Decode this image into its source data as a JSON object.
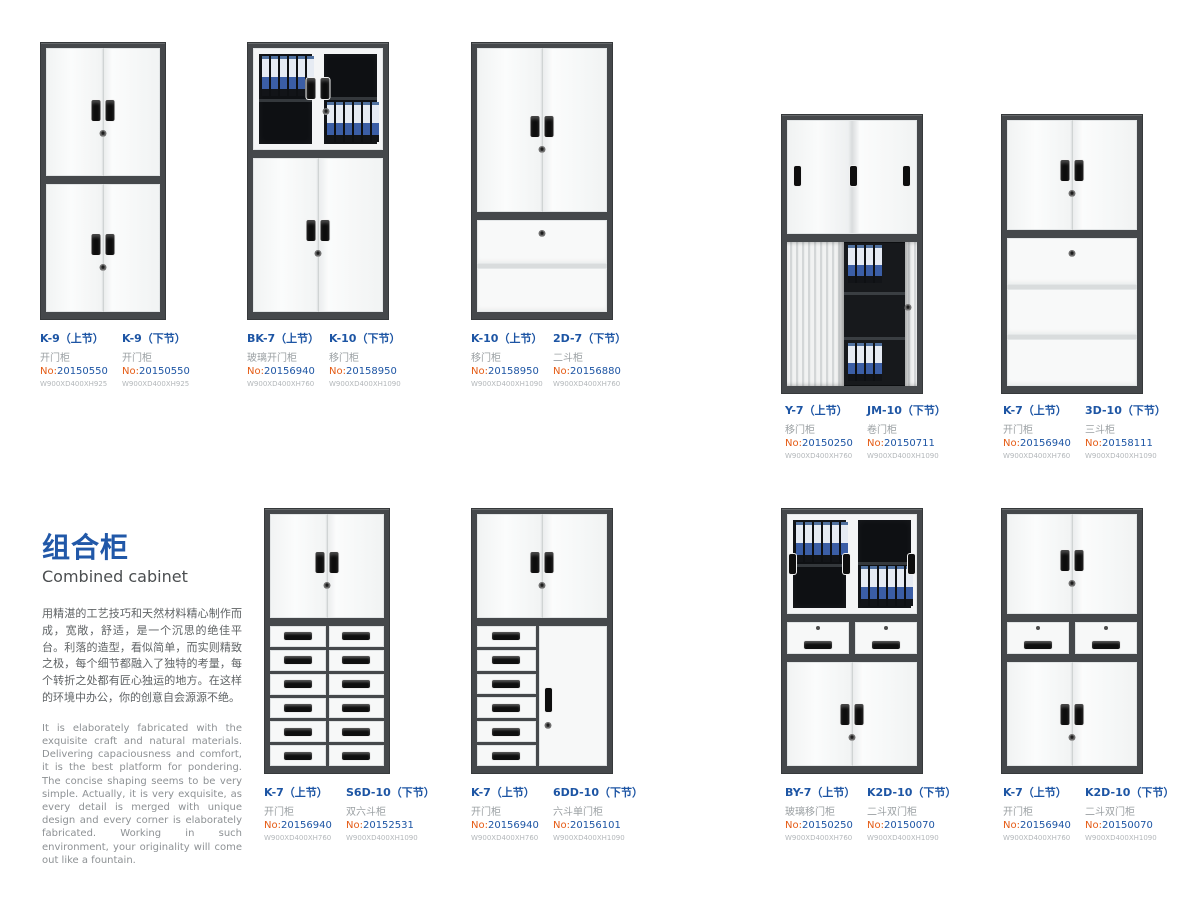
{
  "page": {
    "title_cn": "组合柜",
    "title_en": "Combined cabinet",
    "desc_cn": "用精湛的工艺技巧和天然材料精心制作而成，宽敞，舒适，是一个沉思的绝佳平台。利落的造型，看似简单，而实则精致之极，每个细节都融入了独特的考量，每个转折之处都有匠心独运的地方。在这样的环境中办公，你的创意自会源源不绝。",
    "desc_en": "It is elaborately fabricated with the exquisite craft and natural materials. Delivering capaciousness and comfort, it is the best platform for pondering. The concise shaping seems to be very simple. Actually, it is very exquisite, as every detail is merged with unique design and every corner is elaborately fabricated. Working in such environment, your originality will come out like a fountain."
  },
  "labels_common": {
    "no_prefix": "No:"
  },
  "colors": {
    "accent_blue": "#1d55a4",
    "accent_orange": "#e55b14",
    "frame_dark": "#45484b",
    "binder_blue": "#3b5ea6"
  },
  "products": [
    {
      "labels": [
        {
          "model": "K-9",
          "section": "（上节）",
          "type": "开门柜",
          "no": "20150550",
          "dim": "W900XD400XH925"
        },
        {
          "model": "K-9",
          "section": "（下节）",
          "type": "开门柜",
          "no": "20150550",
          "dim": "W900XD400XH925"
        }
      ]
    },
    {
      "labels": [
        {
          "model": "BK-7",
          "section": "（上节）",
          "type": "玻璃开门柜",
          "no": "20156940",
          "dim": "W900XD400XH760"
        },
        {
          "model": "K-10",
          "section": "（下节）",
          "type": "移门柜",
          "no": "20158950",
          "dim": "W900XD400XH1090"
        }
      ]
    },
    {
      "labels": [
        {
          "model": "K-10",
          "section": "（上节）",
          "type": "移门柜",
          "no": "20158950",
          "dim": "W900XD400XH1090"
        },
        {
          "model": "2D-7",
          "section": "（下节）",
          "type": "二斗柜",
          "no": "20156880",
          "dim": "W900XD400XH760"
        }
      ]
    },
    {
      "labels": [
        {
          "model": "Y-7",
          "section": "（上节）",
          "type": "移门柜",
          "no": "20150250",
          "dim": "W900XD400XH760"
        },
        {
          "model": "JM-10",
          "section": "（下节）",
          "type": "卷门柜",
          "no": "20150711",
          "dim": "W900XD400XH1090"
        }
      ]
    },
    {
      "labels": [
        {
          "model": "K-7",
          "section": "（上节）",
          "type": "开门柜",
          "no": "20156940",
          "dim": "W900XD400XH760"
        },
        {
          "model": "3D-10",
          "section": "（下节）",
          "type": "三斗柜",
          "no": "20158111",
          "dim": "W900XD400XH1090"
        }
      ]
    },
    {
      "labels": [
        {
          "model": "K-7",
          "section": "（上节）",
          "type": "开门柜",
          "no": "20156940",
          "dim": "W900XD400XH760"
        },
        {
          "model": "S6D-10",
          "section": "（下节）",
          "type": "双六斗柜",
          "no": "20152531",
          "dim": "W900XD400XH1090"
        }
      ]
    },
    {
      "labels": [
        {
          "model": "K-7",
          "section": "（上节）",
          "type": "开门柜",
          "no": "20156940",
          "dim": "W900XD400XH760"
        },
        {
          "model": "6DD-10",
          "section": "（下节）",
          "type": "六斗单门柜",
          "no": "20156101",
          "dim": "W900XD400XH1090"
        }
      ]
    },
    {
      "labels": [
        {
          "model": "BY-7",
          "section": "（上节）",
          "type": "玻璃移门柜",
          "no": "20150250",
          "dim": "W900XD400XH760"
        },
        {
          "model": "K2D-10",
          "section": "（下节）",
          "type": "二斗双门柜",
          "no": "20150070",
          "dim": "W900XD400XH1090"
        }
      ]
    },
    {
      "labels": [
        {
          "model": "K-7",
          "section": "（上节）",
          "type": "开门柜",
          "no": "20156940",
          "dim": "W900XD400XH760"
        },
        {
          "model": "K2D-10",
          "section": "（下节）",
          "type": "二斗双门柜",
          "no": "20150070",
          "dim": "W900XD400XH1090"
        }
      ]
    }
  ]
}
